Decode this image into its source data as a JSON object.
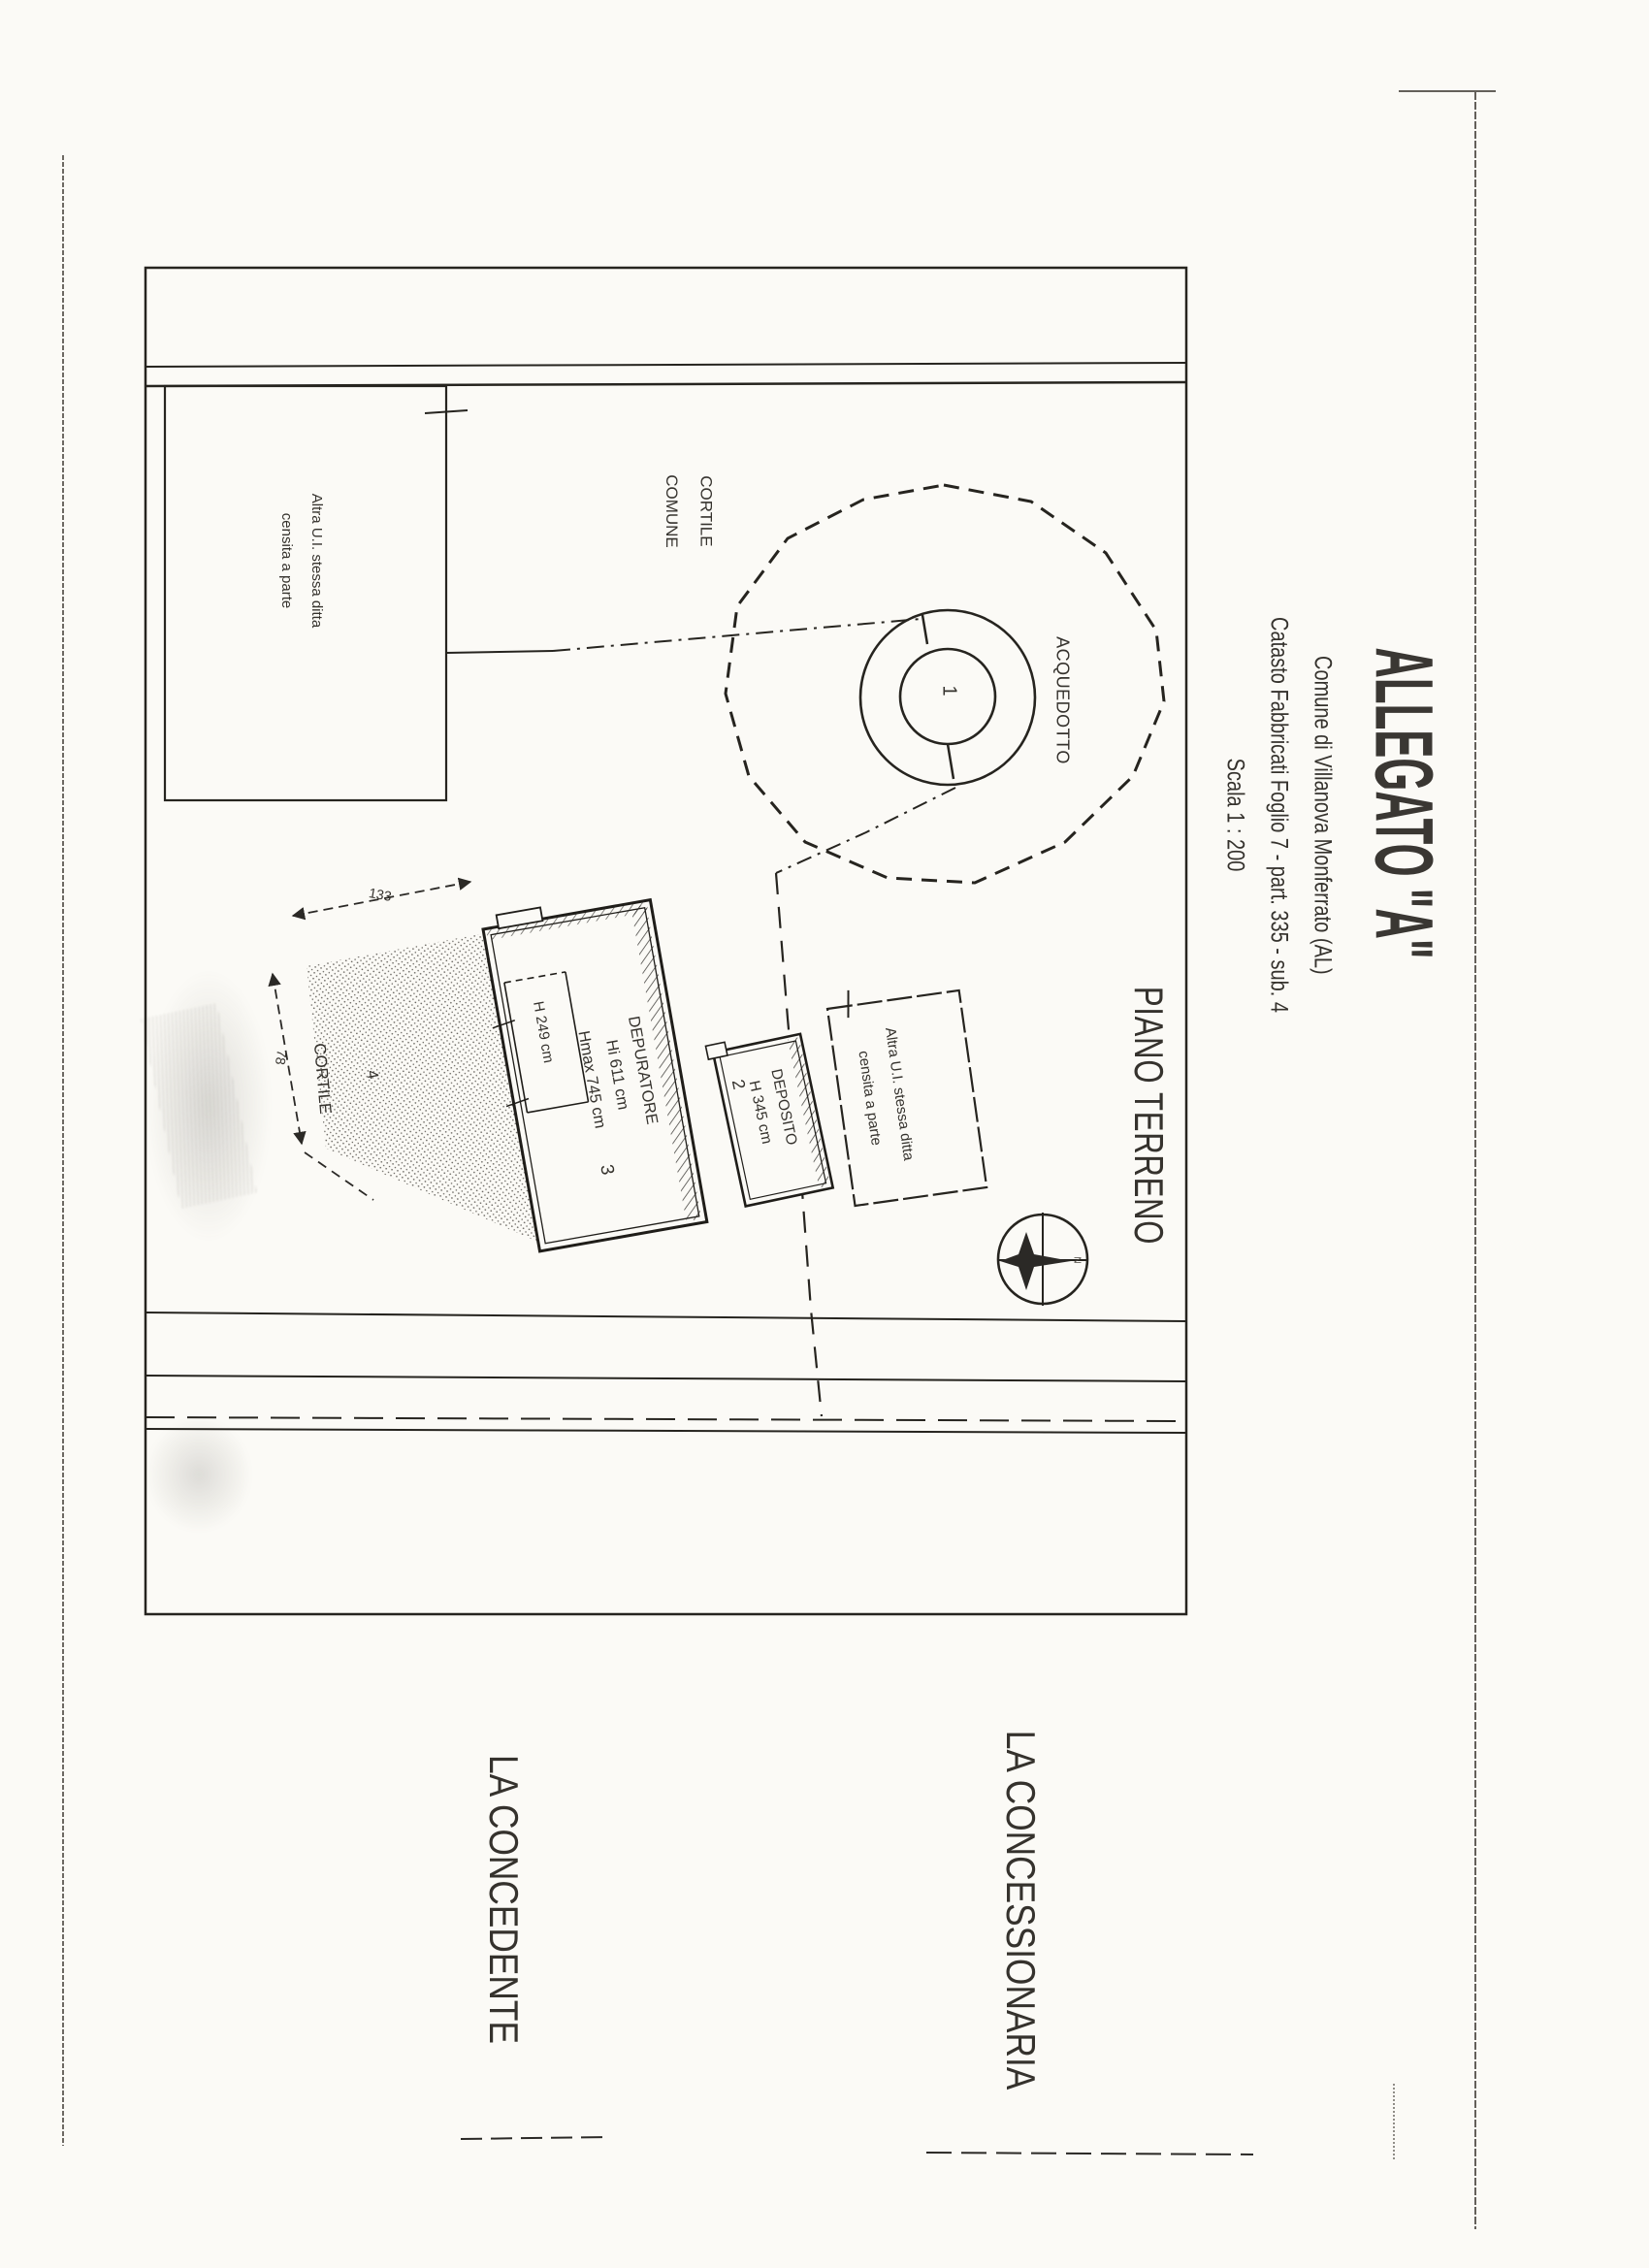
{
  "title_block": {
    "title": "ALLEGATO \"A\"",
    "line1": "Comune di Villanova Monferrato (AL)",
    "line2": "Catasto Fabbricati Foglio 7 - part. 335 - sub. 4",
    "line3": "Scala 1 : 200"
  },
  "plan": {
    "floor_label": "PIANO TERRENO",
    "courtyard_common": {
      "line1": "CORTILE",
      "line2": "COMUNE"
    },
    "aqueduct_label": "ACQUEDOTTO",
    "well_number": "1",
    "other_unit_left": {
      "line1": "Altra U.I. stessa ditta",
      "line2": "censita a parte"
    },
    "other_unit_right": {
      "line1": "Altra U.I. stessa ditta",
      "line2": "censita a parte"
    },
    "courtyard": {
      "label": "CORTILE",
      "number": "4"
    },
    "depurator": {
      "label": "DEPURATORE",
      "height_int": "Hi 611 cm",
      "height_max": "Hmax 745 cm",
      "number": "3",
      "room_height": "H 249 cm"
    },
    "deposit": {
      "label": "DEPOSITO",
      "height": "H 345 cm",
      "number": "2"
    },
    "dimensions": {
      "top": "133",
      "left": "78"
    },
    "compass": {
      "north": "N"
    }
  },
  "signatures": {
    "grantor": "LA CONCEDENTE",
    "concessionaire": "LA CONCESSIONARIA"
  },
  "colors": {
    "ink": "#2b2926",
    "paper": "#fbfaf6"
  }
}
